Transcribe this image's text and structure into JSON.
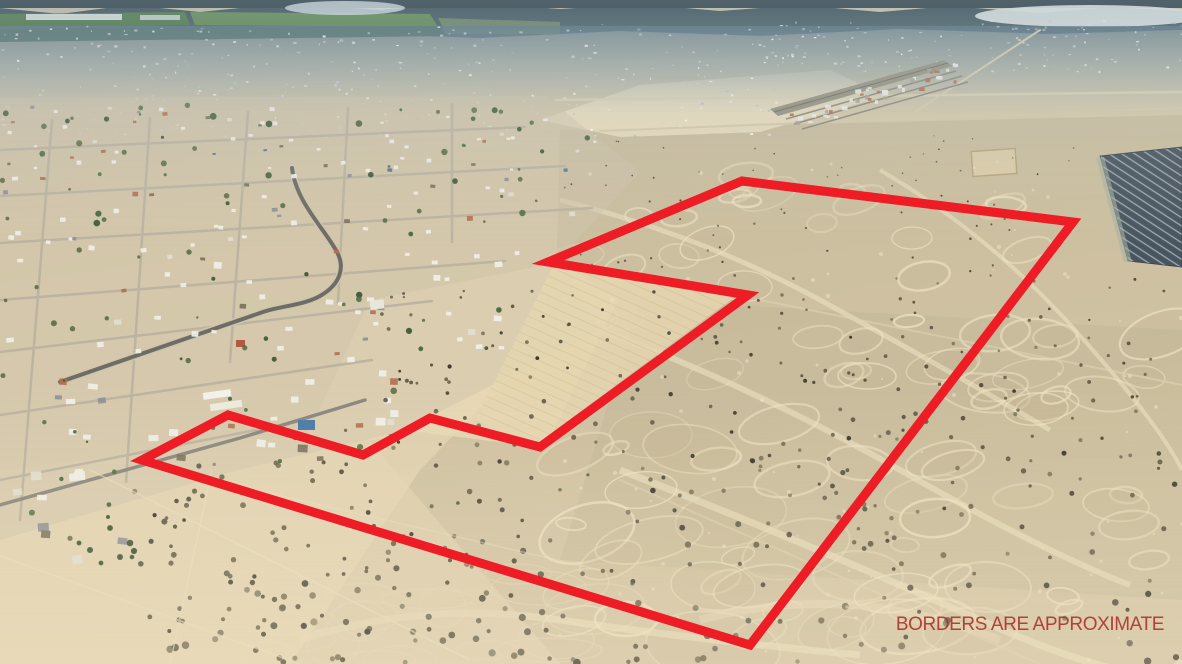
{
  "disclaimer": {
    "text": "BORDERS ARE APPROXIMATE",
    "color": "#ad352c"
  },
  "boundary_overlay": {
    "color": "#ee1c25",
    "stroke_width": 9,
    "points": [
      [
        742,
        181
      ],
      [
        1073,
        222
      ],
      [
        750,
        645
      ],
      [
        142,
        460
      ],
      [
        228,
        415
      ],
      [
        363,
        455
      ],
      [
        430,
        418
      ],
      [
        540,
        447
      ],
      [
        748,
        295
      ],
      [
        548,
        262
      ]
    ]
  }
}
